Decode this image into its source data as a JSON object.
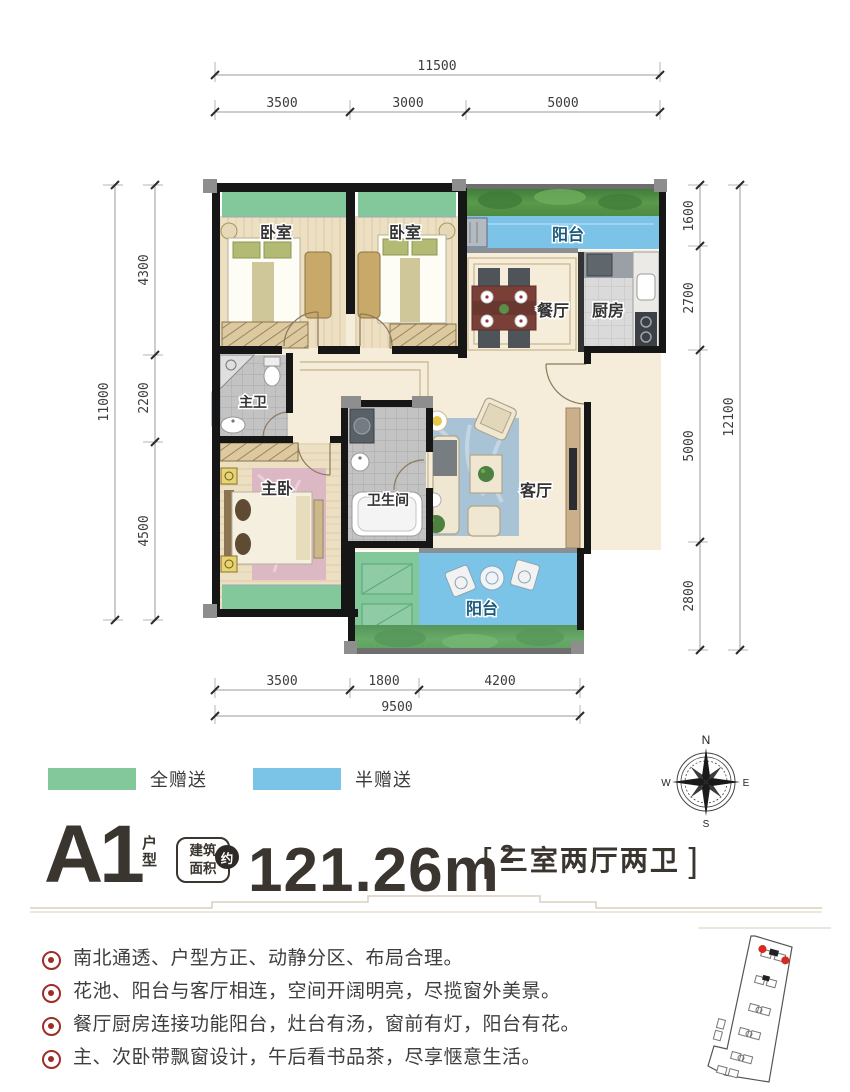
{
  "dims": {
    "top": {
      "total": "11500",
      "segments": [
        "3500",
        "3000",
        "5000"
      ]
    },
    "left": {
      "total": "11000",
      "segments": [
        "4300",
        "2200",
        "4500"
      ]
    },
    "right": {
      "total": "12100",
      "segments": [
        "1600",
        "2700",
        "5000",
        "2800"
      ]
    },
    "bottom": {
      "total": "9500",
      "segments": [
        "3500",
        "1800",
        "4200"
      ]
    }
  },
  "rooms": {
    "bedroom_a": "卧室",
    "bedroom_b": "卧室",
    "balcony_north": "阳台",
    "dining": "餐厅",
    "kitchen": "厨房",
    "master_bath": "主卫",
    "master_bedroom": "主卧",
    "bathroom": "卫生间",
    "living": "客厅",
    "balcony_south": "阳台"
  },
  "legend": {
    "full_gift": {
      "label": "全赠送",
      "color": "#82c89b"
    },
    "half_gift": {
      "label": "半赠送",
      "color": "#7cc3e8"
    }
  },
  "compass": {
    "n": "N",
    "e": "E",
    "s": "S",
    "w": "W"
  },
  "title": {
    "unit": "A1",
    "unit_type": "户型",
    "area_box_line1": "建筑",
    "area_box_line2": "面积",
    "approx": "约",
    "area_value": "121.26",
    "area_unit": "m",
    "area_sup": "2",
    "bracket_left": "[",
    "layout": "三室两厅两卫",
    "bracket_right": "]"
  },
  "features": [
    "南北通透、户型方正、动静分区、布局合理。",
    "花池、阳台与客厅相连，空间开阔明亮，尽揽窗外美景。",
    "餐厅厨房连接功能阳台，灶台有汤，窗前有灯，阳台有花。",
    "主、次卧带飘窗设计，午后看书品茶，尽享惬意生活。"
  ],
  "colors": {
    "full_gift_green": "#82c89b",
    "half_gift_blue": "#7cc3e8",
    "foliage_green": "#57944a",
    "bullet_red": "#9e2d26",
    "keyplan_highlight": "#d42a20",
    "title_ink": "#3b3530"
  }
}
